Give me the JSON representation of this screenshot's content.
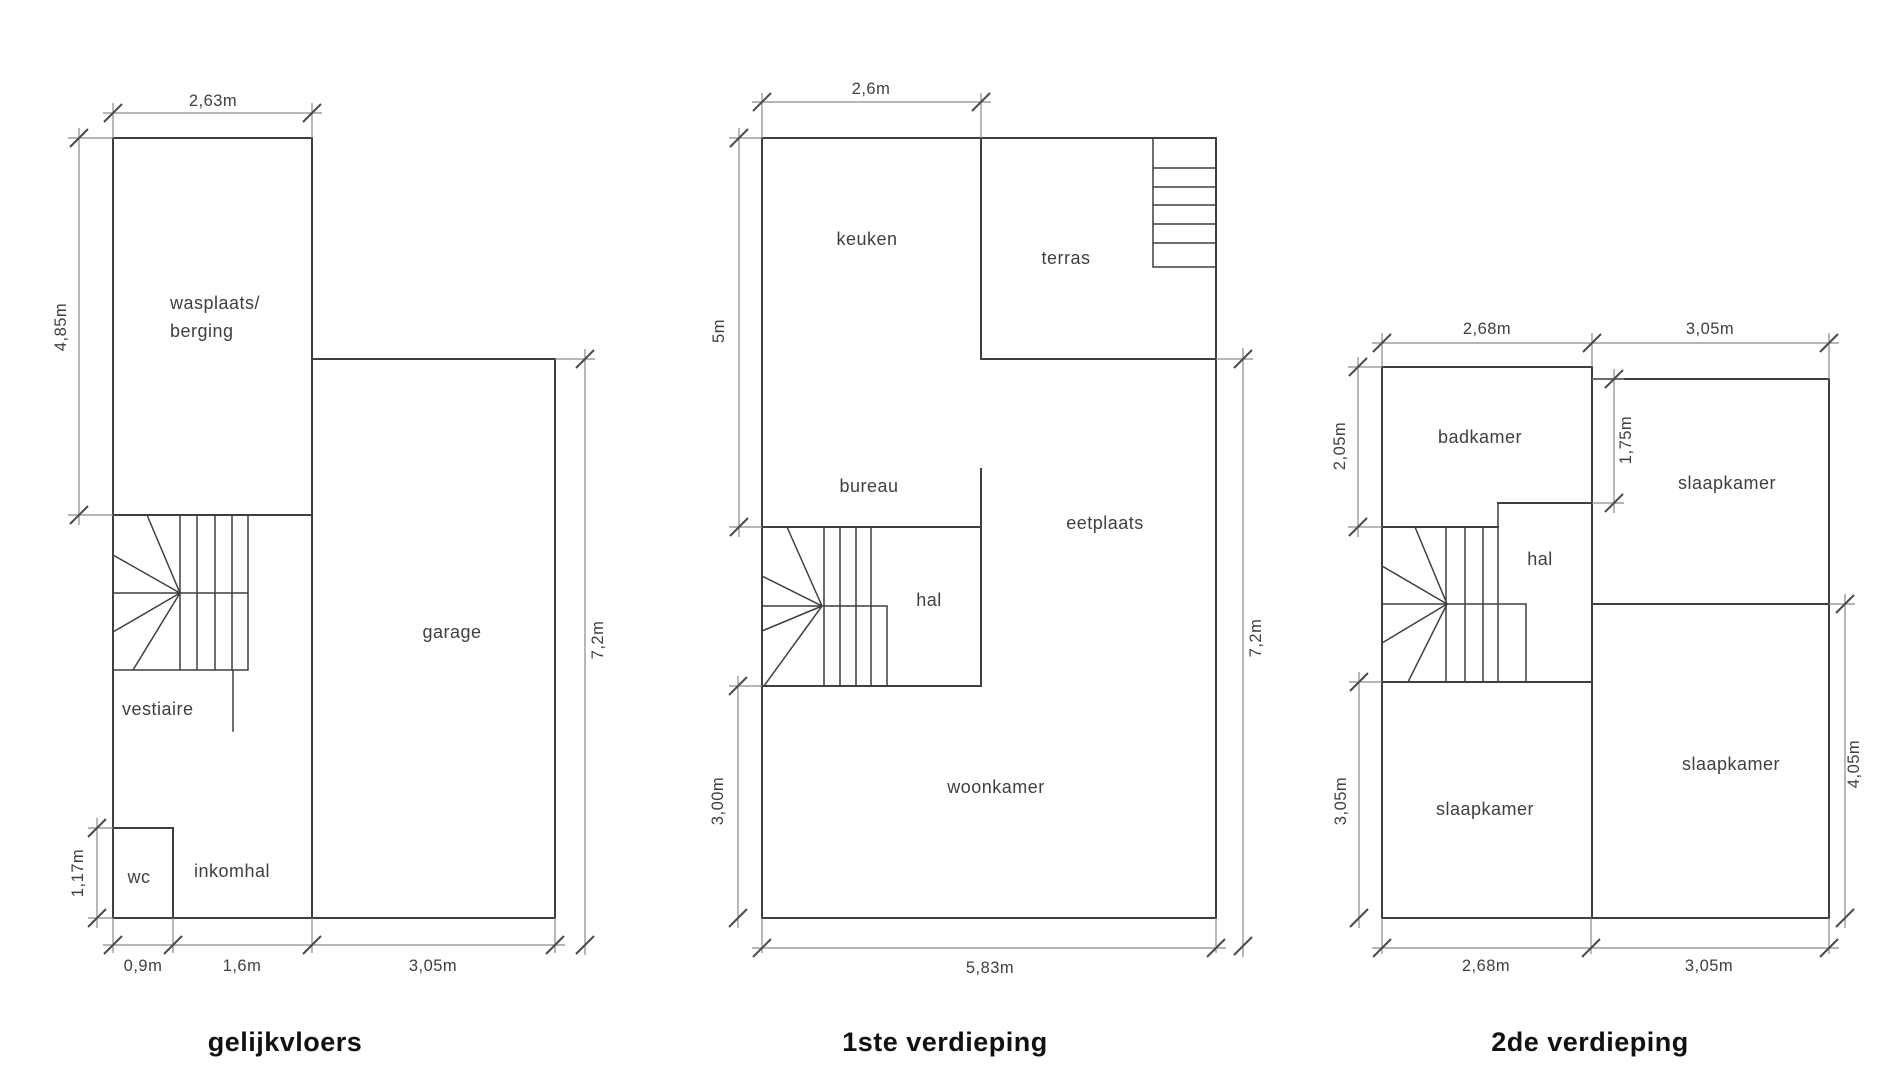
{
  "style": {
    "background": "#ffffff",
    "wall_color": "#3f3f3f",
    "dimension_line_color": "#8a8a8a",
    "text_color": "#3f3f3f",
    "title_color": "#111111"
  },
  "plans": {
    "ground": {
      "title": "gelijkvloers",
      "rooms": {
        "wasplaats_line1": "wasplaats/",
        "wasplaats_line2": "berging",
        "garage": "garage",
        "vestiaire": "vestiaire",
        "wc": "wc",
        "inkomhal": "inkomhal"
      },
      "dims": {
        "top_width": "2,63m",
        "left_height": "4,85m",
        "wc_height": "1,17m",
        "right_height": "7,2m",
        "bottom_1": "0,9m",
        "bottom_2": "1,6m",
        "bottom_3": "3,05m"
      }
    },
    "first": {
      "title": "1ste verdieping",
      "rooms": {
        "keuken": "keuken",
        "terras": "terras",
        "bureau": "bureau",
        "hal": "hal",
        "eetplaats": "eetplaats",
        "woonkamer": "woonkamer"
      },
      "dims": {
        "top_width": "2,6m",
        "left_upper": "5m",
        "left_lower": "3,00m",
        "right_height": "7,2m",
        "bottom_width": "5,83m"
      }
    },
    "second": {
      "title": "2de verdieping",
      "rooms": {
        "badkamer": "badkamer",
        "slaapkamer_top_right": "slaapkamer",
        "hal": "hal",
        "slaapkamer_bottom_left": "slaapkamer",
        "slaapkamer_bottom_right": "slaapkamer"
      },
      "dims": {
        "top_left": "2,68m",
        "top_right": "3,05m",
        "left_upper": "2,05m",
        "mid_height": "1,75m",
        "left_lower": "3,05m",
        "right_height": "4,05m",
        "bottom_left": "2,68m",
        "bottom_right": "3,05m"
      }
    }
  }
}
